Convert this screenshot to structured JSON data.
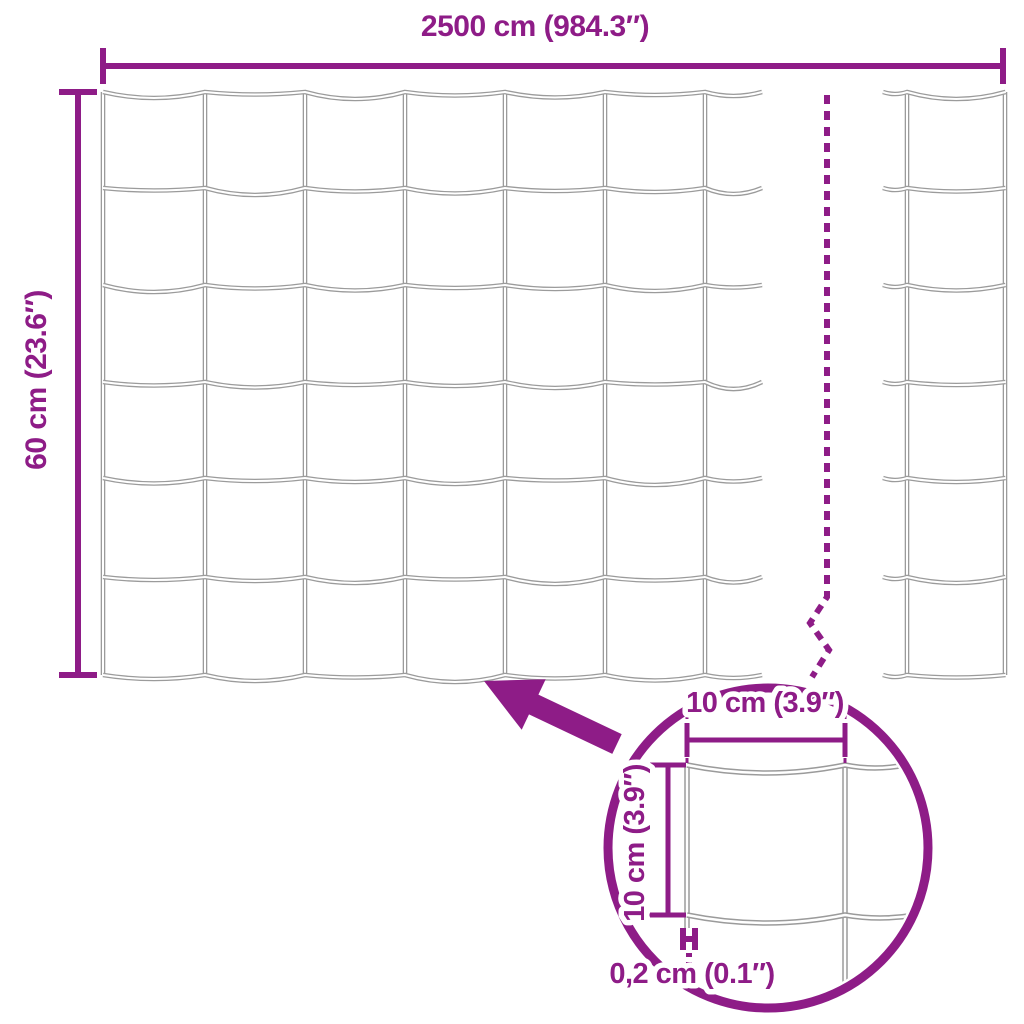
{
  "colors": {
    "accent": "#8E1C87",
    "wire": "#9B9B9B",
    "wire_core": "#FFFFFF",
    "background": "#FFFFFF"
  },
  "labels": {
    "total_width": "2500 cm (984.3″)",
    "total_height": "60 cm (23.6″)",
    "cell_width": "10 cm (3.9″)",
    "cell_height": "10 cm (3.9″)",
    "wire_thickness": "0,2 cm (0.1″)"
  },
  "mesh": {
    "rows": 6,
    "columns_left_section": 6,
    "columns_right_section": 1,
    "break_indicator": true
  },
  "detail_view": {
    "type": "magnifier-circle",
    "shows": "single mesh cell with wire thickness"
  }
}
